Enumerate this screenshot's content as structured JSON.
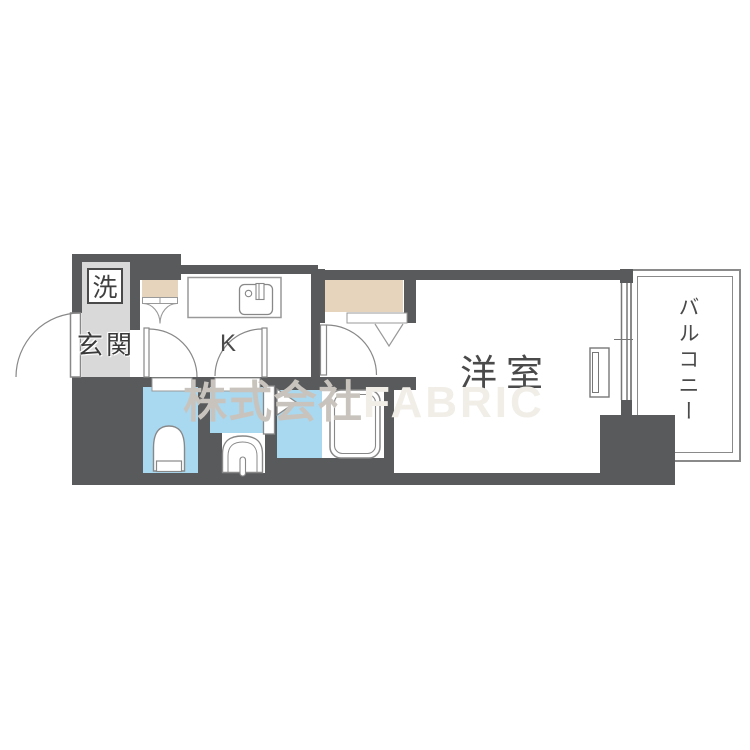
{
  "floorplan": {
    "type": "apartment-floor-plan-1K",
    "labels": {
      "laundry": "洗",
      "entrance": "玄関",
      "kitchen": "K",
      "western_room": "洋室",
      "balcony": "バルコニー"
    },
    "watermark": {
      "company_prefix": "株式会社",
      "brand": "FABRIC"
    },
    "rooms": [
      {
        "name": "entrance-hall",
        "label": "玄関",
        "floor_color": "#d9d9d9"
      },
      {
        "name": "kitchen",
        "label": "K",
        "floor_color": "#ffffff"
      },
      {
        "name": "toilet",
        "floor_color": "#a9d8f1"
      },
      {
        "name": "washroom",
        "floor_color": "#a9d8f1"
      },
      {
        "name": "bathroom",
        "floor_color": "#a9d8f1"
      },
      {
        "name": "western-room",
        "label": "洋室",
        "floor_color": "#ffffff"
      },
      {
        "name": "balcony",
        "label": "バルコニー",
        "floor_color": "#ffffff"
      },
      {
        "name": "closet-small",
        "floor_color": "#e7d4bc"
      },
      {
        "name": "closet-large",
        "floor_color": "#e7d4bc"
      }
    ],
    "fixtures": [
      "washing-machine-space",
      "kitchen-counter-sink",
      "toilet-bowl",
      "washbasin-vanity",
      "bathtub",
      "folding-bath-door",
      "hinged-doors",
      "double-closet-doors",
      "sliding-balcony-window",
      "window-sash"
    ],
    "colors": {
      "wall": "#595a5c",
      "wet_area_floor": "#a9d8f1",
      "closet_fill": "#e7d4bc",
      "entrance_floor": "#d9d9d9",
      "fixture_line": "#8a8a8a",
      "label_text": "#474747",
      "watermark_kanji": "#c8c4bd",
      "watermark_brand": "#f1eee8"
    }
  }
}
